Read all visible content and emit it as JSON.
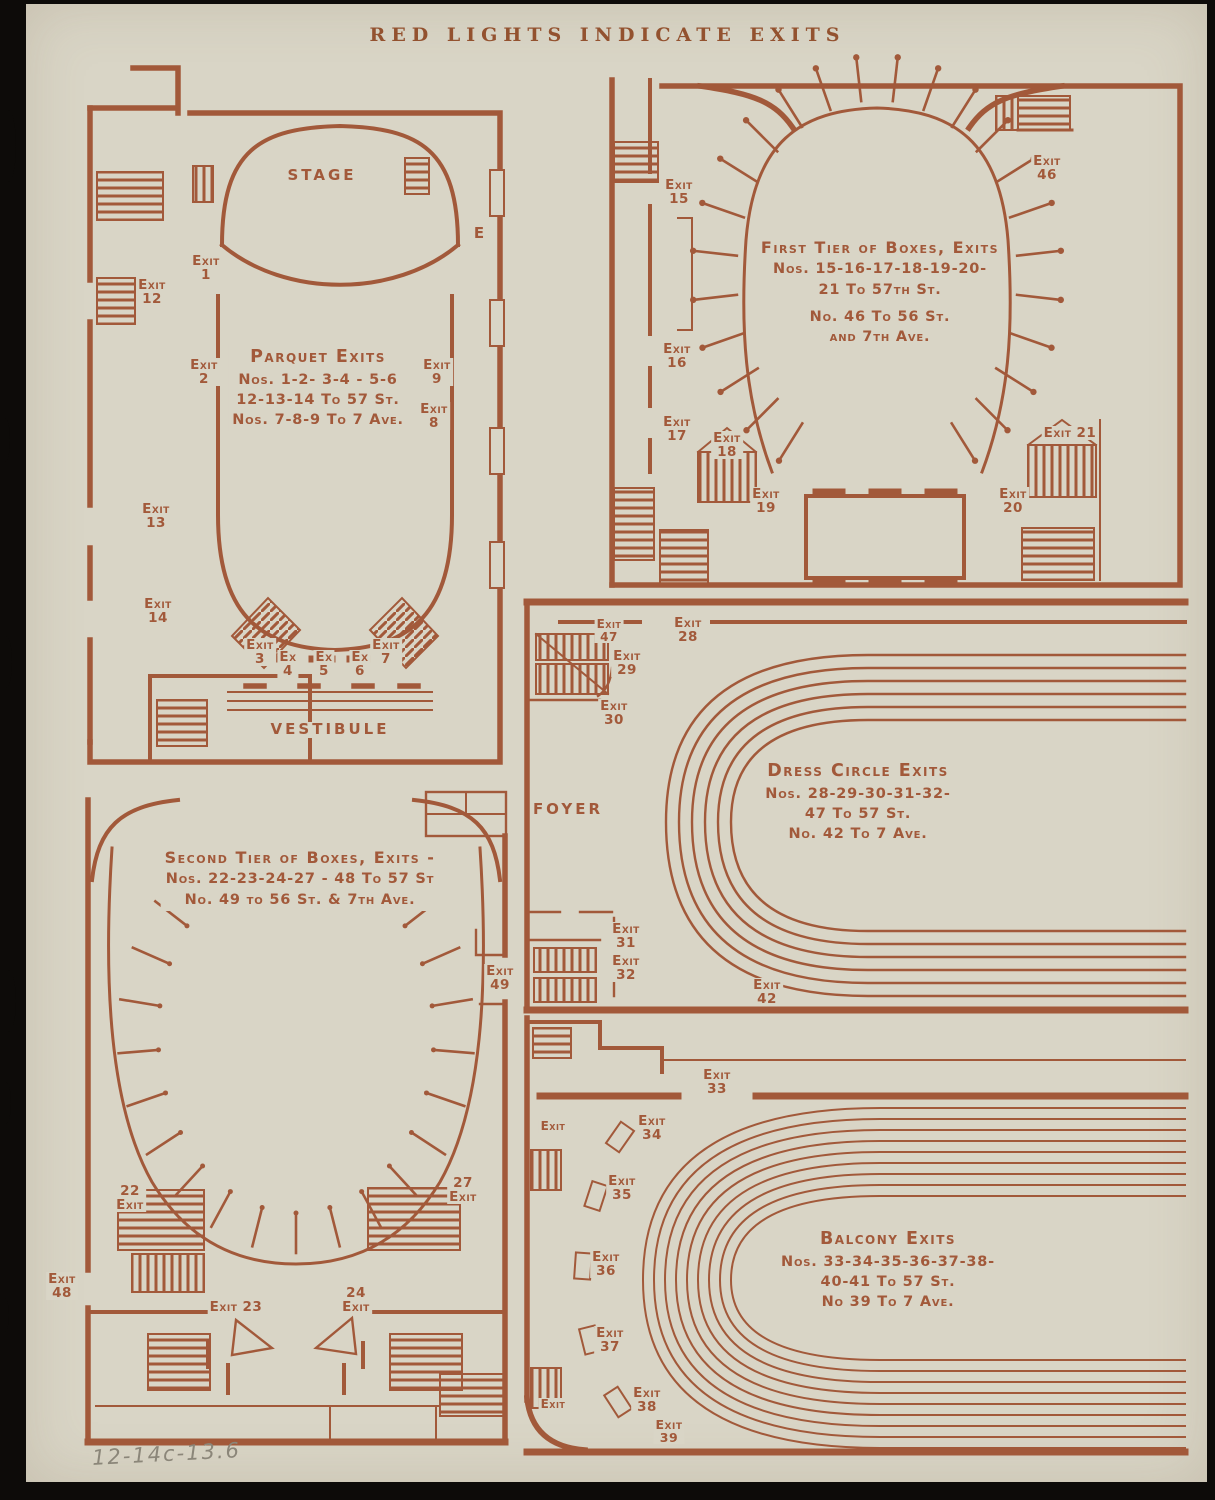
{
  "page": {
    "title": "RED LIGHTS INDICATE EXITS",
    "handwritten_note": "12-14c-13.6",
    "colors": {
      "ink": "#a2593a",
      "paper": "#d9d5c6",
      "background": "#0d0b09",
      "pencil": "#8b8679"
    }
  },
  "plans": {
    "parquet": {
      "stage_label": "STAGE",
      "vestibule_label": "VESTIBULE",
      "e_label": "E",
      "title_lines": [
        "Parquet Exits",
        "Nos. 1-2- 3-4 - 5-6",
        "12-13-14 To 57 St.",
        "Nos. 7-8-9  To 7 Ave."
      ],
      "exits": {
        "x1": {
          "w": "Exit",
          "n": "1"
        },
        "x2": {
          "w": "Exit",
          "n": "2"
        },
        "x3": {
          "w": "Exit",
          "n": "3"
        },
        "x4": {
          "w": "Ex",
          "n": "4"
        },
        "x5": {
          "w": "Ex",
          "n": "5"
        },
        "x6": {
          "w": "Ex",
          "n": "6"
        },
        "x7": {
          "w": "Exit",
          "n": "7"
        },
        "x8": {
          "w": "Exit",
          "n": "8"
        },
        "x9": {
          "w": "Exit",
          "n": "9"
        },
        "x12": {
          "w": "Exit",
          "n": "12"
        },
        "x13": {
          "w": "Exit",
          "n": "13"
        },
        "x14": {
          "w": "Exit",
          "n": "14"
        }
      }
    },
    "first_tier": {
      "title_lines": [
        "First Tier of Boxes, Exits",
        "Nos. 15-16-17-18-19-20-",
        "21 To 57th St.",
        "No.  46 To 56 St.",
        "and 7th Ave."
      ],
      "exits": {
        "x15": {
          "w": "Exit",
          "n": "15"
        },
        "x16": {
          "w": "Exit",
          "n": "16"
        },
        "x17": {
          "w": "Exit",
          "n": "17"
        },
        "x18": {
          "w": "Exit",
          "n": "18"
        },
        "x19": {
          "w": "Exit",
          "n": "19"
        },
        "x20": {
          "w": "Exit",
          "n": "20"
        },
        "x46": {
          "w": "Exit",
          "n": "46"
        },
        "x21": {
          "label": "Exit 21"
        }
      }
    },
    "dress_circle": {
      "foyer_label": "FOYER",
      "title_lines": [
        "Dress Circle Exits",
        "Nos. 28-29-30-31-32-",
        "47 To 57 St.",
        "No. 42 To  7 Ave."
      ],
      "exits": {
        "x47": {
          "w": "Exit",
          "n": "47"
        },
        "x28": {
          "w": "Exit",
          "n": "28"
        },
        "x29": {
          "w": "Exit",
          "n": "29"
        },
        "x30": {
          "w": "Exit",
          "n": "30"
        },
        "x31": {
          "w": "Exit",
          "n": "31"
        },
        "x32": {
          "w": "Exit",
          "n": "32"
        },
        "x42": {
          "w": "Exit",
          "n": "42"
        }
      }
    },
    "second_tier": {
      "title_lines": [
        "Second Tier of Boxes, Exits -",
        "Nos. 22-23-24-27 - 48 To 57 St",
        "No.  49 to 56 St. & 7th Ave."
      ],
      "exits": {
        "x22": {
          "w": "Exit",
          "n": "22"
        },
        "x48": {
          "w": "Exit",
          "n": "48"
        },
        "x23": {
          "label": "Exit 23"
        },
        "x24": {
          "w": "Exit",
          "n": "24"
        },
        "x27": {
          "w": "Exit",
          "n": "27"
        },
        "x49": {
          "w": "Exit",
          "n": "49"
        }
      }
    },
    "balcony": {
      "title_lines": [
        "Balcony Exits",
        "Nos. 33-34-35-36-37-38-",
        "40-41 To 57 St.",
        "No 39 To 7 Ave."
      ],
      "exits": {
        "x33": {
          "w": "Exit",
          "n": "33"
        },
        "x34": {
          "w": "Exit",
          "n": "34"
        },
        "x35": {
          "w": "Exit",
          "n": "35"
        },
        "x36": {
          "w": "Exit",
          "n": "36"
        },
        "x37": {
          "w": "Exit",
          "n": "37"
        },
        "x38": {
          "w": "Exit",
          "n": "38"
        },
        "x39": {
          "w": "Exit",
          "n": "39"
        },
        "plain_a": {
          "label": "Exit"
        },
        "plain_b": {
          "label": "Exit"
        }
      }
    }
  }
}
